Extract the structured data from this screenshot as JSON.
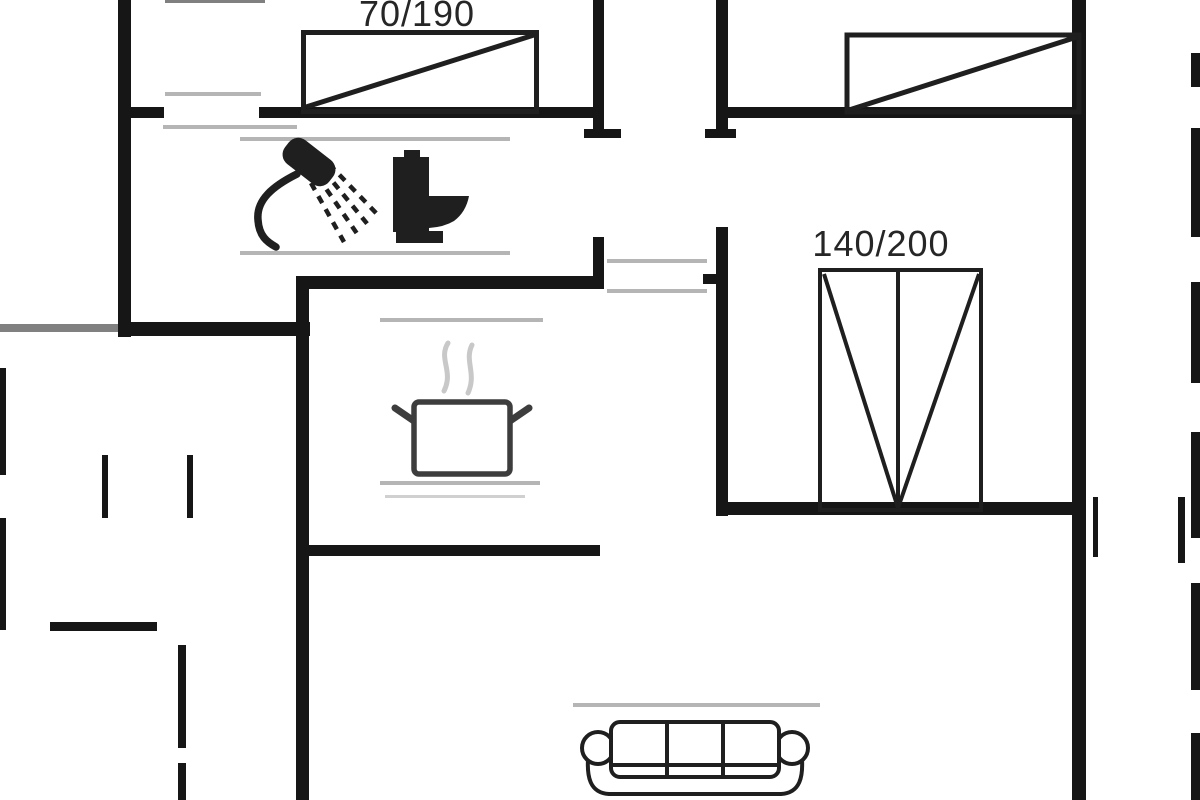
{
  "labels": {
    "bed_single": "70/190",
    "bed_double": "140/200"
  },
  "colors": {
    "bg": "#ffffff",
    "wall": "#161616",
    "furniture": "#1f1f1f",
    "faint": "#b5b5b5",
    "faint_light": "#d0d0d0",
    "edge": "#808080",
    "pot": "#3d3d3d",
    "steam": "#c8c8c8",
    "text": "#262626"
  },
  "icons": {
    "shower": "shower-icon",
    "toilet": "toilet-icon",
    "cooking_pot": "cooking-pot-icon",
    "sofa": "sofa-icon",
    "single_bed": "single-bed-icon",
    "double_bed": "double-bed-icon"
  }
}
